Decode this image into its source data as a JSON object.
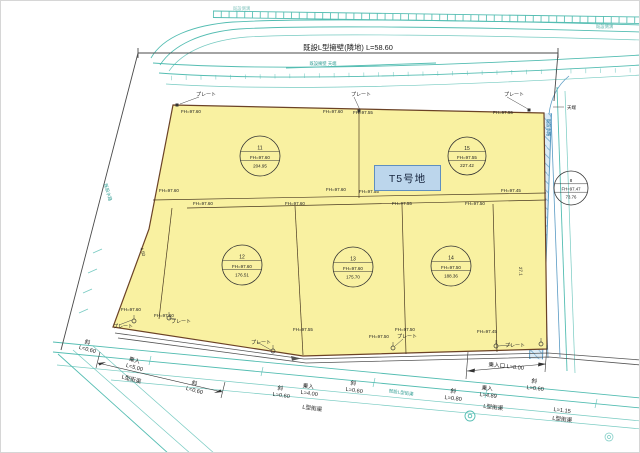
{
  "colors": {
    "lot_fill": "#f9f1a1",
    "lot_edge": "#6b4226",
    "road_teal": "#54bdb2",
    "water_blue": "#5a9bc4",
    "label_box_fill": "#bcd6ec",
    "label_box_edge": "#5f8fc0"
  },
  "labels": {
    "t5": "T5号地",
    "wall_label": "既設L型擁壁(隣地) L=58.60",
    "plate": "プレート",
    "tenba": "天端",
    "slope": "斜",
    "gutter": "L型街渠",
    "len_060": "L=0.60",
    "len_080": "L=0.80",
    "len_115": "L=1.15",
    "entry": "乗入",
    "len_500": "L=5.00",
    "len_400": "L=4.00",
    "len_489": "L=4.89",
    "entry_mouth": "乗入口 L=8.00",
    "existing_gutter": "既設L型街渠",
    "existing_channel": "既設水路",
    "wall_top_note": "既設擁壁 天端",
    "side_ditch_note": "既設側溝",
    "dim_450": "4.50",
    "dim_271": "27.1"
  },
  "fh": {
    "v760": "FH=97.60",
    "v755": "FH=97.55",
    "v750": "FH=97.50",
    "v747": "FH=97.47",
    "v745": "FH=97.45"
  },
  "lots": [
    {
      "id": "11",
      "fh": "FH=97.60",
      "area": "204.95"
    },
    {
      "id": "12",
      "fh": "FH=97.60",
      "area": "176.51"
    },
    {
      "id": "13",
      "fh": "FH=97.60",
      "area": "175.70"
    },
    {
      "id": "14",
      "fh": "FH=97.50",
      "area": "188.36"
    },
    {
      "id": "15",
      "fh": "FH=97.55",
      "area": "227.42"
    },
    {
      "id": "8",
      "fh": "FH=97.47",
      "area": "73.76"
    }
  ]
}
